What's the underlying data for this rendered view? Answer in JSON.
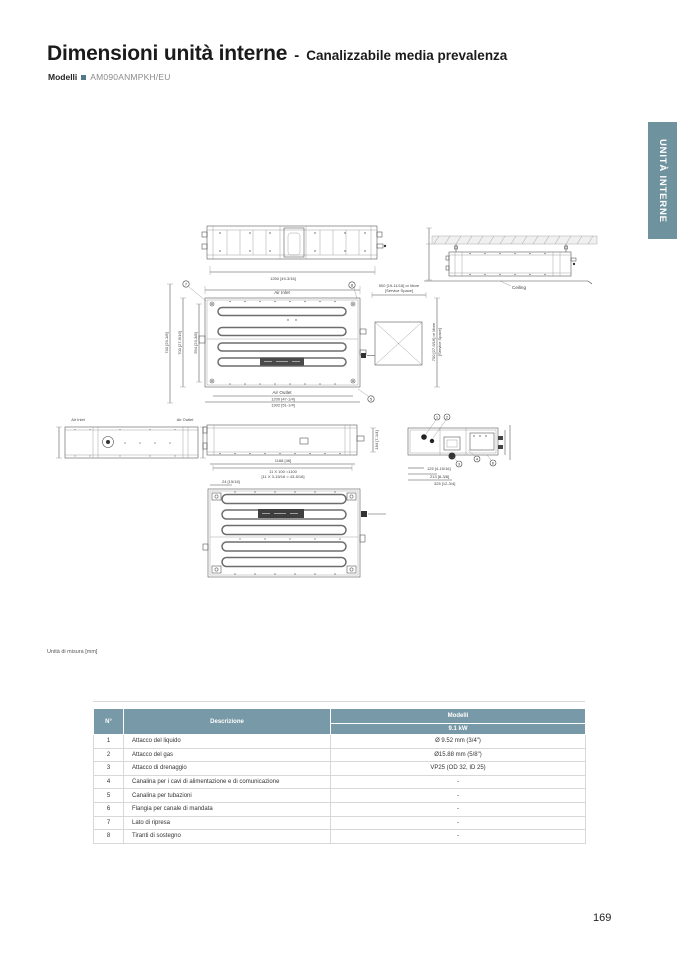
{
  "header": {
    "title_main": "Dimensioni unità interne",
    "title_sep": "-",
    "title_sub": "Canalizzabile media prevalenza",
    "models_label": "Modelli",
    "model_value": "AM090ANMPKH/EU"
  },
  "side_tab": {
    "label": "UNITÀ INTERNE",
    "color": "#6f929f"
  },
  "drawings": {
    "labels": {
      "air_inlet": "Air Inlet",
      "air_outlet": "Air Outlet",
      "ceiling": "Ceiling"
    },
    "dims": {
      "d1250": "1250 [49-3/16]",
      "d1200": "1200 [47-1/4]",
      "d1302": "1302 [51-1/4]",
      "d740": "740 [29-1/8]",
      "d700": "700 [27-9/16]",
      "d594": "594 [23-3/8]",
      "service_w": "500 [19-11/16] or More",
      "service_sp": "[Service Space]",
      "service_h": "700 [27-9/16] or More",
      "d1168": "1168 [46]",
      "pitch": "11 X 100 =1100",
      "pitch_in": "[11 X 3-15/16 = 43-5/16]",
      "d24": "24 [15/16]",
      "d184": "184 [7-1/4]",
      "d125": "125 [4-15/16]",
      "d213": "213 [8-3/8]",
      "d325": "325 [12-3/4]"
    },
    "callouts": {
      "c1": "1",
      "c2": "2",
      "c3": "3",
      "c4": "4",
      "c5": "5",
      "c6": "6",
      "c7": "7",
      "c8": "8"
    }
  },
  "unit_note": "Unità di misura [mm]",
  "table": {
    "col_num": "N°",
    "col_desc": "Descrizione",
    "col_models": "Modelli",
    "col_power": "9.1 kW",
    "rows": [
      {
        "n": "1",
        "desc": "Attacco del liquido",
        "value": "Ø 9.52 mm (3/4\")"
      },
      {
        "n": "2",
        "desc": "Attacco del gas",
        "value": "Ø15.88 mm (5/8\")"
      },
      {
        "n": "3",
        "desc": "Attacco di drenaggio",
        "value": "VP25 (OD 32, ID 25)"
      },
      {
        "n": "4",
        "desc": "Canalina per i cavi di alimentazione e di comunicazione",
        "value": "-"
      },
      {
        "n": "5",
        "desc": "Canalina per tubazioni",
        "value": "-"
      },
      {
        "n": "6",
        "desc": "Flangia per canale di mandata",
        "value": "-"
      },
      {
        "n": "7",
        "desc": "Lato di ripresa",
        "value": "-"
      },
      {
        "n": "8",
        "desc": "Tiranti di sostegno",
        "value": "-"
      }
    ]
  },
  "page_number": "169"
}
